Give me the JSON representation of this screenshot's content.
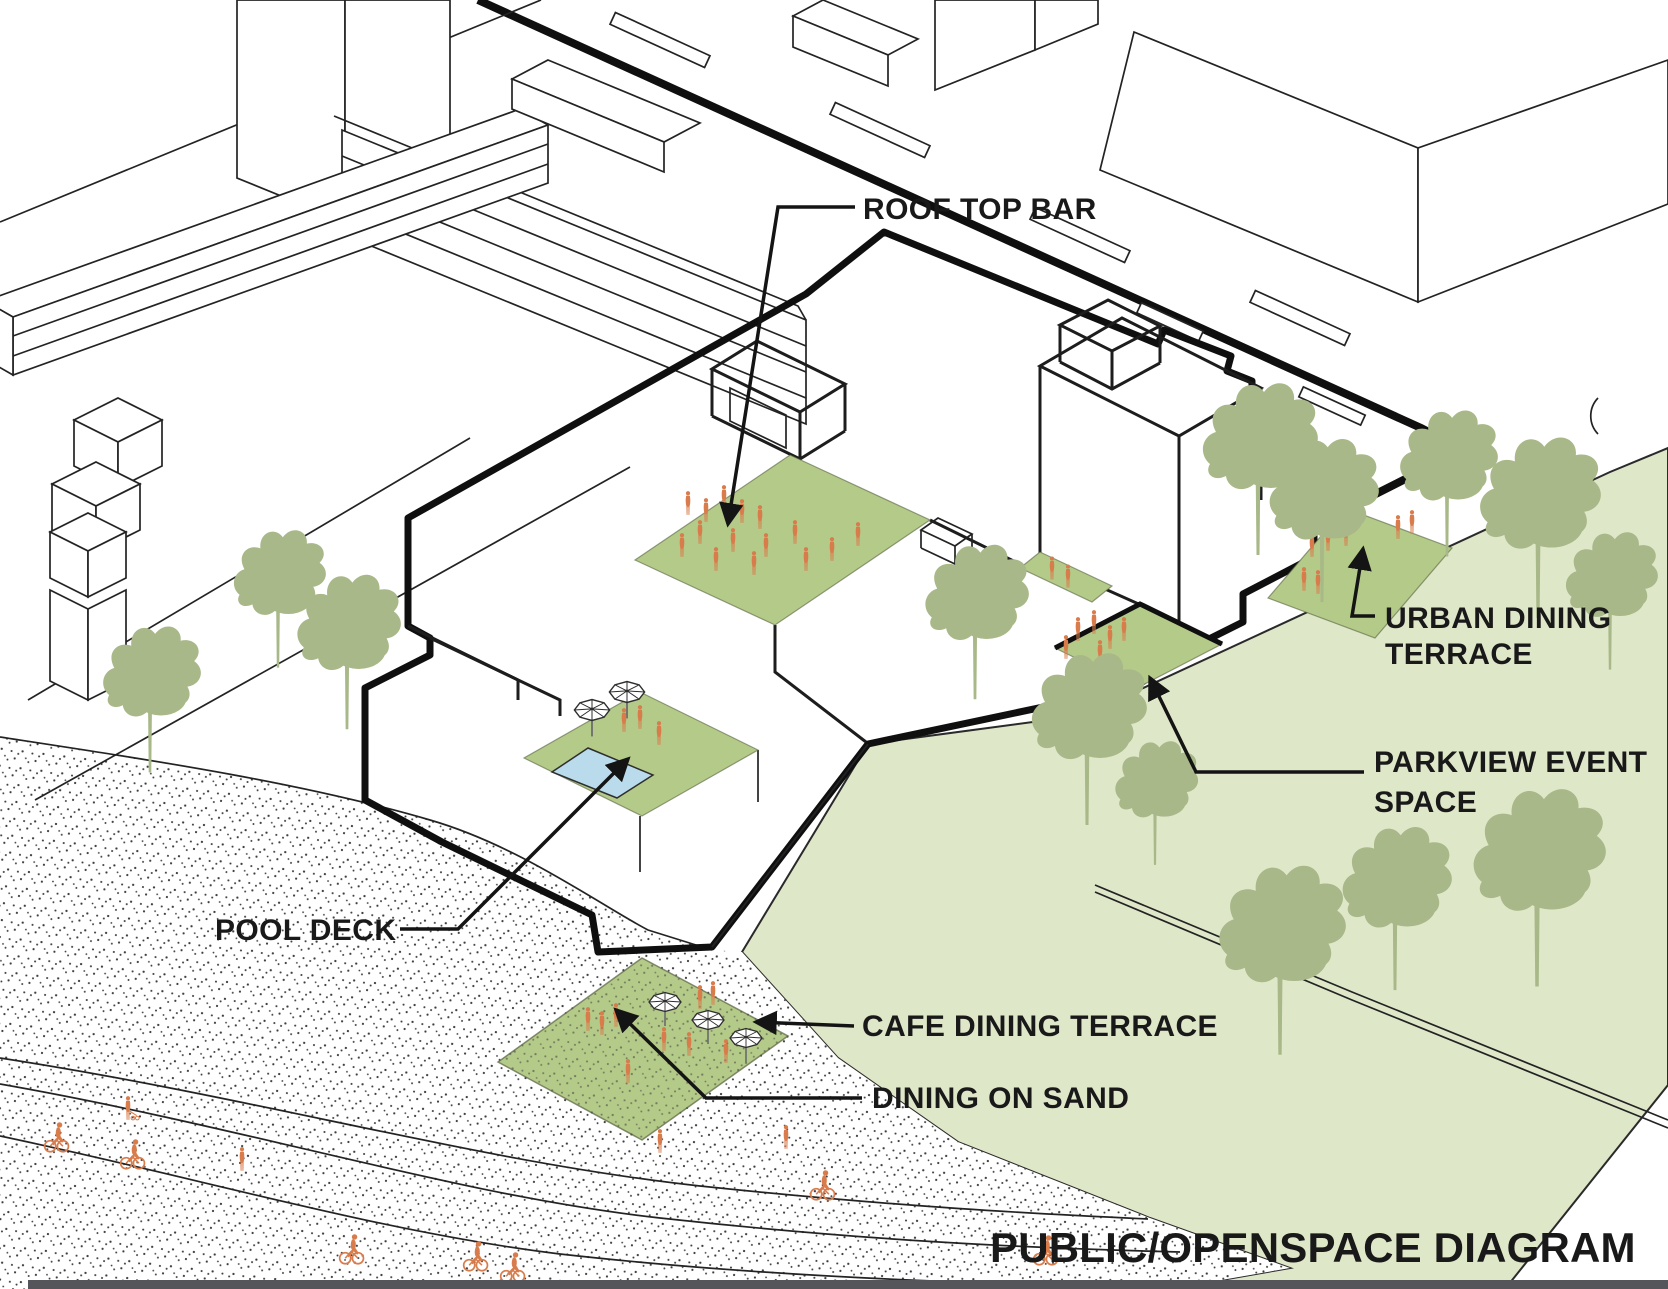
{
  "diagram": {
    "title": "PUBLIC/OPENSPACE DIAGRAM",
    "labels": {
      "roof_top_bar": "ROOF TOP BAR",
      "urban_dining_terrace_line1": "URBAN DINING",
      "urban_dining_terrace_line2": "TERRACE",
      "parkview_event_space_line1": "PARKVIEW EVENT",
      "parkview_event_space_line2": "SPACE",
      "pool_deck": "POOL DECK",
      "cafe_dining_terrace": "CAFE DINING TERRACE",
      "dining_on_sand": "DINING ON SAND"
    },
    "colors": {
      "terrace_green": "#b4ca88",
      "park_green": "#dfe7c9",
      "tree_green": "#a8b888",
      "people_orange": "#d97c4c",
      "pool_blue": "#b9dbec",
      "line_black": "#141414",
      "footer_bar": "#53555a"
    }
  }
}
